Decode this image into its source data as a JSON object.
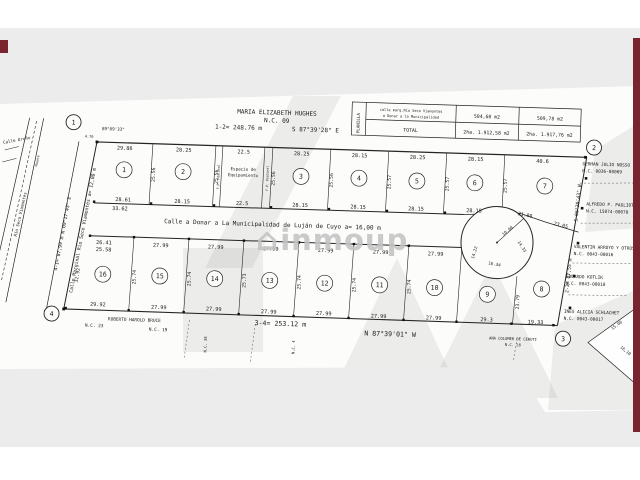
{
  "watermark": {
    "logo": "⌂",
    "text": "inmoup"
  },
  "accents": {
    "maroon": "#7a2430",
    "band_gray": "#ececec"
  },
  "title_block": {
    "owner": "MARIA ELIZABETH HUGHES",
    "nc": "N.C. 09",
    "segment": "1-2= 248.76 m",
    "bearing": "S 87°39'28\" E"
  },
  "summary_table": {
    "side": "PLANILLA",
    "r1l1": "calle marg.Río Seco Viamontes",
    "r1l2": "a Donar a la Municipalidad",
    "r1v1": "504,60 m2",
    "r1v2": "509,78 m2",
    "r2label": "TOTAL",
    "r2v1": "2ha. 1.912,58 m2",
    "r2v2": "2ha. 1.917,76 m2"
  },
  "vertices": {
    "v1": "1",
    "v2": "2",
    "v3": "3",
    "v4": "4",
    "angle": "89°09'33\""
  },
  "streets": {
    "center": "Calle a Donar a La Municipalidad de Luján de Cuyo a= 16,00 m",
    "marginal": "Calle Marginal Río Seco Viamontes a= 12,00 m",
    "marginal_seg": "4-1= 87,99 m  N 09°17'43\" E",
    "orono": "Calle Oroño",
    "puente": "Puente",
    "rio": "Río Seco Viamontes"
  },
  "boundaries": {
    "right_bearing": "S 06°30'43\" W",
    "right_seg": "2-3= 87,55 m",
    "bottom_seg": "3-4= 253.12 m",
    "bottom_bearing": "N 87°39'01\" W",
    "d470": "4.70",
    "d1500": "15.00",
    "d1610": "16,10"
  },
  "lots": {
    "top": [
      {
        "n": "1",
        "t": "29.86",
        "b": "28.61",
        "b2": "33.62"
      },
      {
        "n": "2",
        "t": "28.25",
        "b": "28.15"
      },
      {
        "n": "3",
        "t": "28.25",
        "b": "28.15"
      },
      {
        "n": "4",
        "t": "28.15",
        "b": "28.15"
      },
      {
        "n": "5",
        "t": "28.25",
        "b": "28.15"
      },
      {
        "n": "6",
        "t": "28.15",
        "b": "28.15"
      },
      {
        "n": "7",
        "t": "40.6",
        "ba": "21.89",
        "bb": "23.05"
      }
    ],
    "top_sides": [
      "25.56",
      "25.56",
      "25.56",
      "25.56",
      "25.57",
      "25.57",
      "25.57"
    ],
    "espacio": {
      "l1": "Espacio de",
      "l2": "Equipamiento",
      "t": "22.5",
      "b": "22.5",
      "fp": "F.P. Peatonal"
    },
    "bottom": [
      {
        "n": "16",
        "ta": "26.41",
        "tb": "25.58",
        "b": "29.92",
        "s": "32.92"
      },
      {
        "n": "15",
        "t": "27.99",
        "b": "27.99",
        "s": "25.74"
      },
      {
        "n": "14",
        "t": "27.99",
        "b": "27.99",
        "s": "25.74"
      },
      {
        "n": "13",
        "t": "27.99",
        "b": "27.99",
        "s": "25.73"
      },
      {
        "n": "12",
        "t": "27.99",
        "b": "27.99",
        "s": "25.74"
      },
      {
        "n": "11",
        "t": "27.99",
        "b": "27.99",
        "s": "25.74"
      },
      {
        "n": "10",
        "t": "27.99",
        "b": "27.99",
        "s": "25.74"
      },
      {
        "n": "9",
        "b": "29.3",
        "s": "23.79"
      },
      {
        "n": "8",
        "b": "19.33"
      }
    ]
  },
  "culdesac": {
    "r": "10.00",
    "dl": "14.22",
    "dr": "14.33",
    "db": "16.34"
  },
  "neighbors_right": [
    {
      "name": "GERMAN JULIO NOSSO",
      "nc": "N.C. 0036-00069"
    },
    {
      "name": "ALFREDO P. PAGLIOTO",
      "nc": "N.C. 15074-00070"
    },
    {
      "name": "VALENTIN ARROYO Y OTROS",
      "nc": "N.C. 0043-00016"
    },
    {
      "name": "EDUARDO KOTLIK",
      "nc": "N.C. 0043-00018"
    },
    {
      "name": "INES ALICIA SCHLACHET",
      "nc": "N.C. 0043-00017"
    }
  ],
  "neighbors_bottom": {
    "name1": "ROBERTO HAROLD BRUCE",
    "nc23": "N.C. 23",
    "nc19": "N.C. 19",
    "name2": "ANA COLOMER DE CERUTI",
    "nc28": "N.C. 28",
    "nc38": "N.C. 38",
    "nc4": "N.C. 4"
  }
}
